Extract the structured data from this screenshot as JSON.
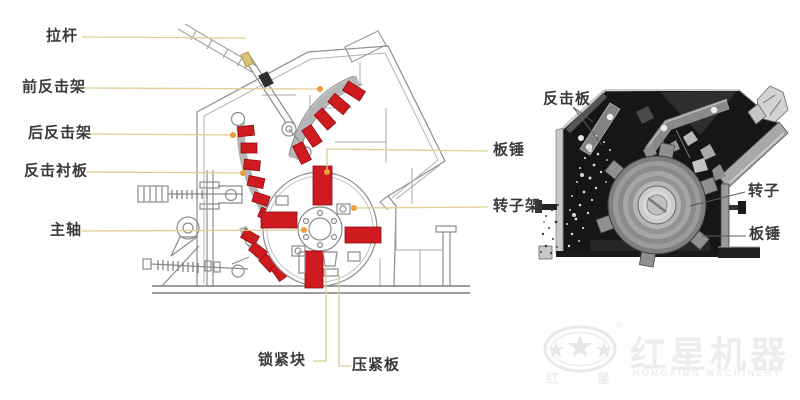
{
  "figure": {
    "left_diagram": {
      "labels": {
        "pull_rod": "拉杆",
        "front_impact_frame": "前反击架",
        "rear_impact_frame": "后反击架",
        "impact_liner_plate": "反击衬板",
        "main_shaft": "主轴",
        "lock_block": "锁紧块",
        "press_plate": "压紧板",
        "blow_bar": "板锤",
        "rotor_frame": "转子架"
      }
    },
    "right_photo": {
      "labels": {
        "impact_plate": "反击板",
        "rotor": "转子",
        "blow_bar": "板锤"
      }
    },
    "watermark": {
      "brand_cn": "红星机器",
      "brand_en": "HONGXING MACHINERY",
      "seal_cn_left": "红",
      "seal_cn_right": "星",
      "registered_mark": "®"
    },
    "colors": {
      "highlight_red": "#cf1a1f",
      "leader_line_tan": "#dfcd96",
      "anchor_dot_orange": "#ea9e38",
      "drawing_line_gray": "#8c8c8c"
    }
  }
}
